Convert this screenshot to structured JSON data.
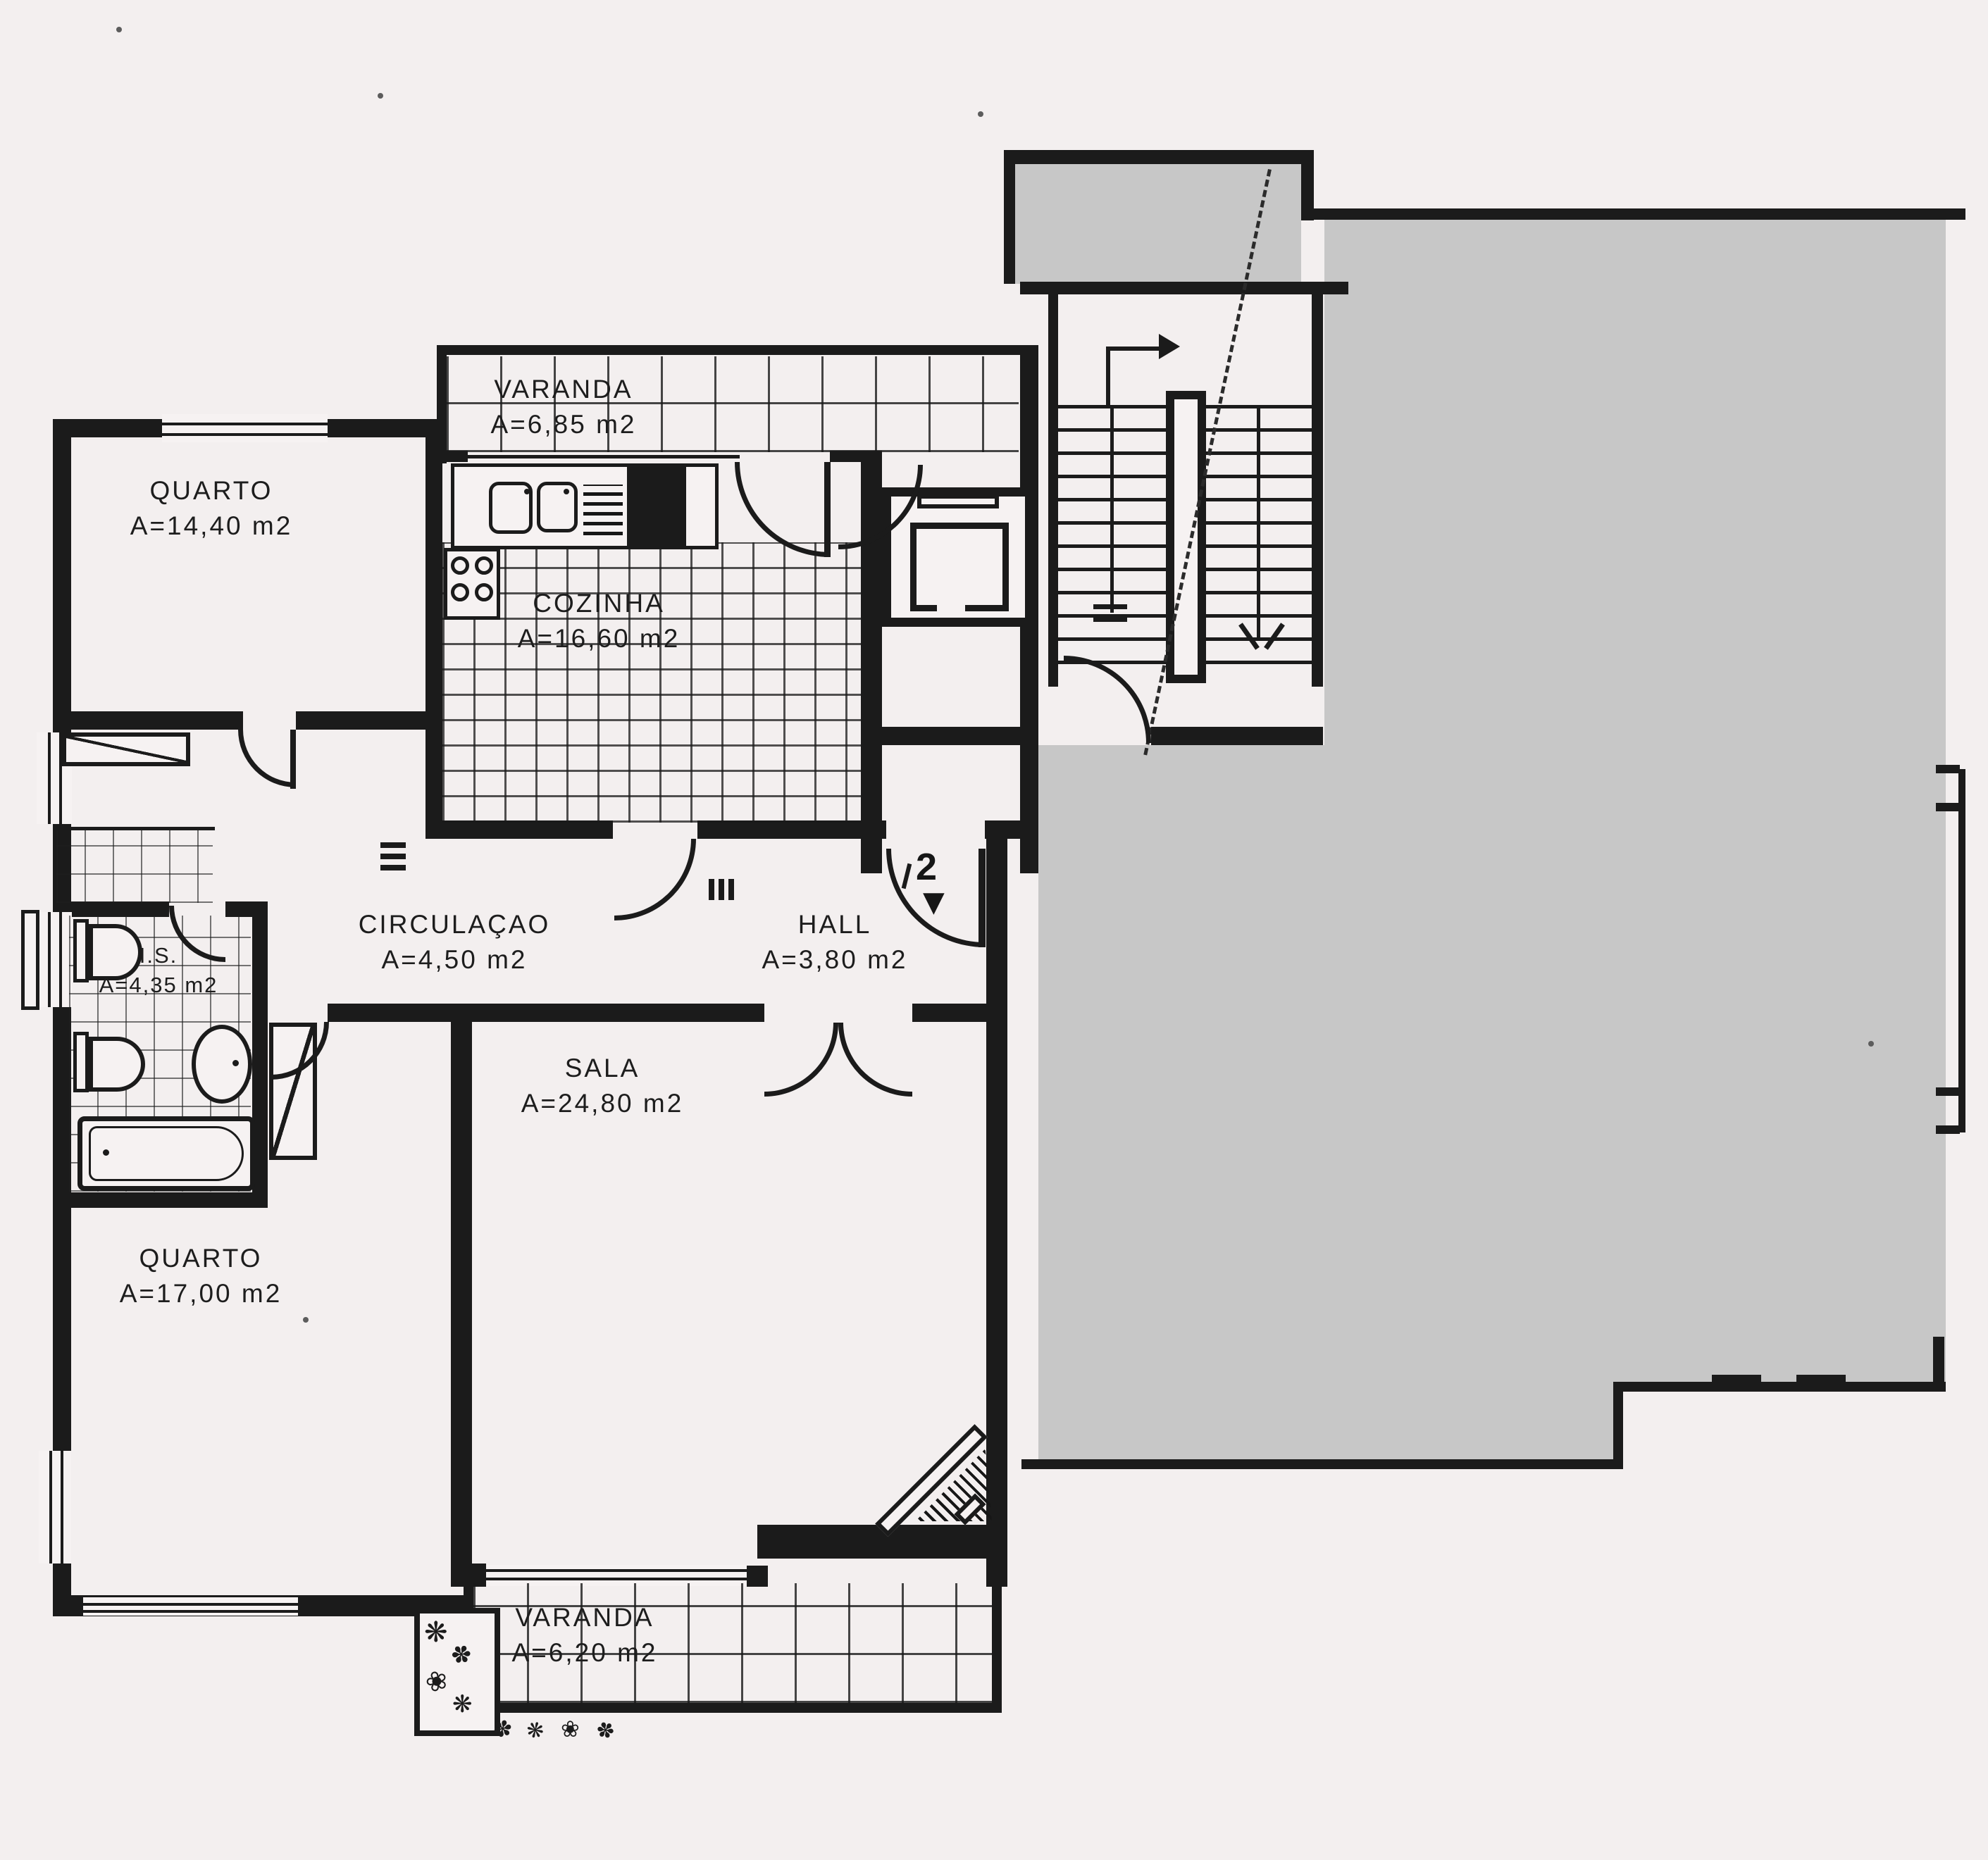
{
  "document": {
    "type": "apartment-floor-plan",
    "language": "pt"
  },
  "rooms": [
    {
      "key": "varanda_top",
      "label": "VARANDA",
      "area": "A=6,85  m2"
    },
    {
      "key": "quarto_top",
      "label": "QUARTO",
      "area": "A=14,40  m2"
    },
    {
      "key": "cozinha",
      "label": "COZINHA",
      "area": "A=16,60  m2"
    },
    {
      "key": "circulacao",
      "label": "CIRCULAÇAO",
      "area": "A=4,50  m2"
    },
    {
      "key": "hall",
      "label": "HALL",
      "area": "A=3,80  m2"
    },
    {
      "key": "is",
      "label": "I.S.",
      "area": "A=4,35 m2"
    },
    {
      "key": "sala",
      "label": "SALA",
      "area": "A=24,80  m2"
    },
    {
      "key": "quarto_bottom",
      "label": "QUARTO",
      "area": "A=17,00  m2"
    },
    {
      "key": "varanda_bottom",
      "label": "VARANDA",
      "area": "A=6,20  m2"
    }
  ],
  "markers": {
    "entrance_number": "2",
    "entrance_arrow": "▼"
  },
  "colors": {
    "paper": "#f3efef",
    "ink": "#1b1b1b",
    "mask_gray": "#c7c7c7"
  }
}
